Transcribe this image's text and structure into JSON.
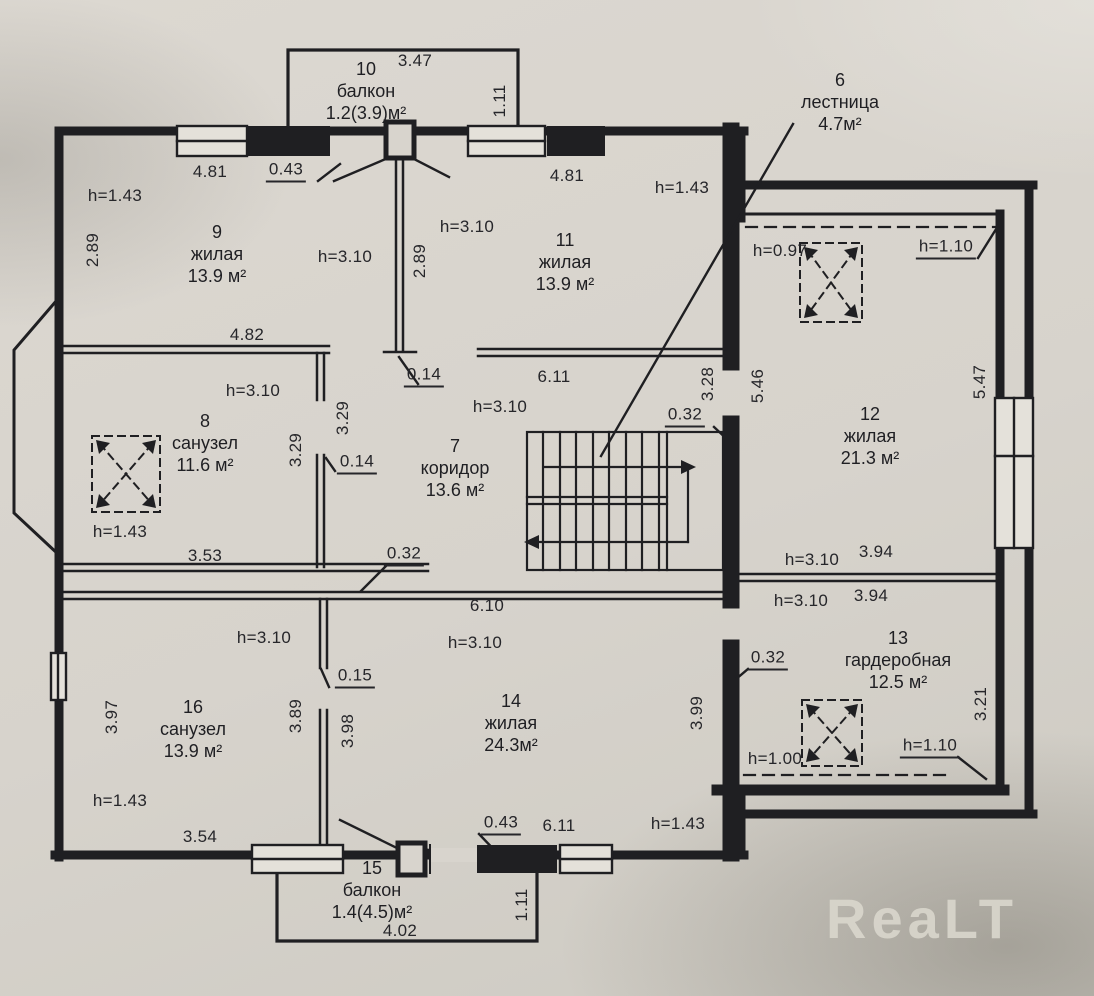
{
  "watermark": "ReaLT",
  "rooms": {
    "r6": {
      "num": "6",
      "name": "лестница",
      "area": "4.7м²"
    },
    "r7": {
      "num": "7",
      "name": "коридор",
      "area": "13.6 м²"
    },
    "r8": {
      "num": "8",
      "name": "санузел",
      "area": "11.6 м²"
    },
    "r9": {
      "num": "9",
      "name": "жилая",
      "area": "13.9 м²"
    },
    "r10": {
      "num": "10",
      "name": "балкон",
      "area": "1.2(3.9)м²"
    },
    "r11": {
      "num": "11",
      "name": "жилая",
      "area": "13.9 м²"
    },
    "r12": {
      "num": "12",
      "name": "жилая",
      "area": "21.3 м²"
    },
    "r13": {
      "num": "13",
      "name": "гардеробная",
      "area": "12.5 м²"
    },
    "r14": {
      "num": "14",
      "name": "жилая",
      "area": "24.3м²"
    },
    "r15": {
      "num": "15",
      "name": "балкон",
      "area": "1.4(4.5)м²"
    },
    "r16": {
      "num": "16",
      "name": "санузел",
      "area": "13.9 м²"
    }
  },
  "heights": {
    "h097": "h=0.97",
    "h100": "h=1.00",
    "h110": "h=1.10",
    "h143": "h=1.43",
    "h310": "h=3.10"
  },
  "dims": {
    "d347": "3.47",
    "d111": "1.11",
    "d481": "4.81",
    "d043": "0.43",
    "d289": "2.89",
    "d482": "4.82",
    "d611": "6.11",
    "d610": "6.10",
    "d014": "0.14",
    "d015": "0.15",
    "d032": "0.32",
    "d328": "3.28",
    "d329": "3.29",
    "d353": "3.53",
    "d354": "3.54",
    "d394": "3.94",
    "d397": "3.97",
    "d389": "3.89",
    "d398": "3.98",
    "d399": "3.99",
    "d321": "3.21",
    "d546": "5.46",
    "d547": "5.47",
    "d402": "4.02"
  },
  "colors": {
    "ink": "#1f1f22",
    "paper": "#d8d4cd",
    "window": "#e4e1da"
  }
}
